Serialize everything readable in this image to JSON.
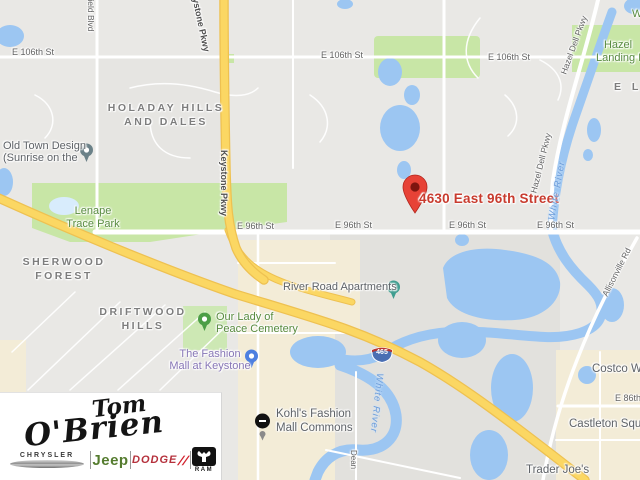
{
  "marker": {
    "label": "4630 East 96th Street"
  },
  "shield": {
    "number": "465"
  },
  "streets": {
    "e106_w": "E 106th St",
    "e106_c": "E 106th St",
    "e106_e": "E 106th St",
    "e96_1": "E 96th St",
    "e96_2": "E 96th St",
    "e96_3": "E 96th St",
    "e96_4": "E 96th St",
    "e86": "E 86th",
    "westfield": "field Blvd",
    "keystone_top": "Keystone Pkwy",
    "keystone_mid": "Keystone Pkwy",
    "hazeldell_1": "Hazel Dell Pkwy",
    "hazeldell_2": "Hazel Dell Pkwy",
    "allisonville": "Allisonville Rd",
    "dean": "Dean"
  },
  "neighborhoods": {
    "holaday_1": "HOLADAY HILLS",
    "holaday_2": "AND DALES",
    "sherwood_1": "SHERWOOD",
    "sherwood_2": "FOREST",
    "driftwood_1": "DRIFTWOOD",
    "driftwood_2": "HILLS",
    "el": "E L"
  },
  "parks": {
    "lenape_1": "Lenape",
    "lenape_2": "Trace Park",
    "hazel_landing_1": "Hazel",
    "hazel_landing_2": "Landing Par",
    "our_lady_1": "Our Lady of",
    "our_lady_2": "Peace Cemetery",
    "w_corner": "W"
  },
  "pois": {
    "old_town_1": "Old Town Design",
    "old_town_2": "(Sunrise on the",
    "river_road": "River Road Apartments",
    "fashion_mall_1": "The Fashion",
    "fashion_mall_2": "Mall at Keystone",
    "kohls_1": "Kohl's Fashion",
    "kohls_2": "Mall Commons",
    "costco": "Costco Wh",
    "castleton": "Castleton Squar",
    "trader_joes": "Trader Joe's"
  },
  "water": {
    "river_1": "White River",
    "river_2": "White River"
  },
  "logo": {
    "script_top": "Tom",
    "script_bottom": "O'Brien",
    "chrysler": "CHRYSLER",
    "jeep": "Jeep",
    "dodge": "DODGE",
    "dodge_slashes": "//",
    "ram": "RAM"
  },
  "colors": {
    "marker_red": "#d33a2c",
    "highway_yellow": "#fbd763",
    "water_blue": "#9cc6f2",
    "park_green": "#c8e6a6",
    "park_text_green": "#588b3f",
    "shop_text_purple": "#8776b6",
    "jeep_green": "#557c2f",
    "dodge_red": "#b5313c"
  }
}
